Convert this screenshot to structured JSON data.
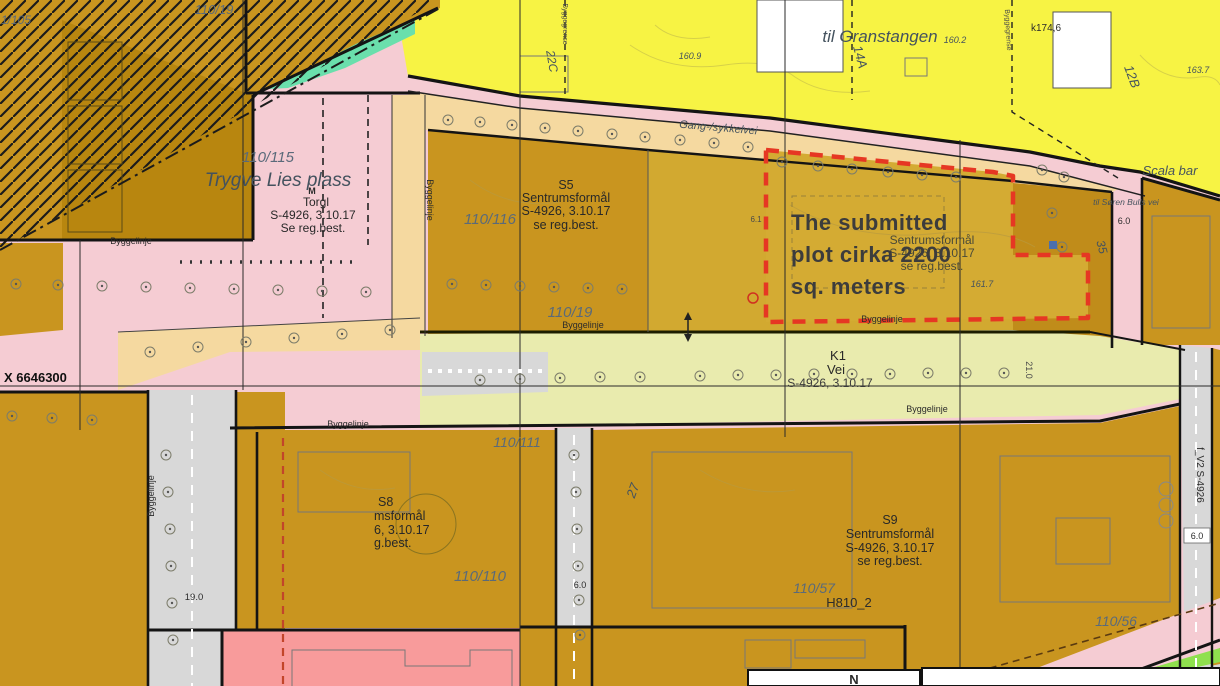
{
  "map": {
    "annotation": {
      "line1": "The submitted",
      "line2": "plot cirka 2200",
      "line3": "sq. meters"
    },
    "places": {
      "granstangen": "til Granstangen",
      "trygve_lies_plass": "Trygve Lies plass",
      "scala": "Scala bar",
      "soren_bulls": "til Søren Bulls vei",
      "gang_sykkelvei": "Gang-/sykkelvei",
      "metro_mark": "M"
    },
    "zones": {
      "torg": {
        "name": "Torgl",
        "plan": "S-4926, 3.10.17",
        "note": "Se reg.best."
      },
      "s5": {
        "code": "S5",
        "name": "Sentrumsformål",
        "plan": "S-4926, 3.10.17",
        "note": "se reg.best."
      },
      "s8": {
        "code": "S8",
        "name": "msformål",
        "plan": "6, 3.10.17",
        "note": "g.best."
      },
      "s9": {
        "code": "S9",
        "name": "Sentrumsformål",
        "plan": "S-4926, 3.10.17",
        "note": "se reg.best."
      },
      "k1": {
        "code": "K1",
        "name": "Vei",
        "plan": "S-4926, 3.10.17"
      },
      "plot_under": {
        "name": "Sentrumsformål",
        "plan": "S-4926, 3.10.17",
        "note": "se reg.best."
      },
      "h810": "H810_2",
      "fv2": "f_V2 S-4926"
    },
    "parcels": {
      "p110_115": "110/115",
      "p110_116": "110/116",
      "p110_19": "110/19",
      "p110_19_top": "110/19",
      "p110_111": "110/111",
      "p110_110": "110/110",
      "p110_57": "110/57",
      "p110_56": "110/56",
      "p1_105": "1/105"
    },
    "lines": {
      "byggelinje": "Byggelinje",
      "byggegrense": "Byggegrense"
    },
    "grid": {
      "x_label": "X 6646300"
    },
    "house_numbers": {
      "n14a": "14A",
      "n12b": "12B",
      "n22c": "22C",
      "n35": "35",
      "n27": "27"
    },
    "dimensions": {
      "d6_0a": "6.0",
      "d6_0b": "6.0",
      "d6_0c": "6.0",
      "d6_1": "6.1",
      "d19_0": "19.0",
      "d21_0": "21.0"
    },
    "elevations": {
      "k174": "k174,6",
      "e160_2": "160.2",
      "e160_9": "160.9",
      "e163_7": "163.7",
      "e161_7": "161.7"
    },
    "legend": {
      "north": "N"
    },
    "colors": {
      "ochre": "#c9951f",
      "ochre_dark": "#b8860f",
      "ochre_wash": "#d2a930",
      "yellow": "#f7f344",
      "pink": "#f5ccd3",
      "salmon": "#f89b9b",
      "olive_road": "#e9ebae",
      "gray_road": "#d8d8d8",
      "tan": "#f5d9a0",
      "green": "#8fe04e",
      "teal": "#6adfac",
      "plot_outline_red": "#e63723",
      "blue_dot": "#4a6fae"
    }
  }
}
